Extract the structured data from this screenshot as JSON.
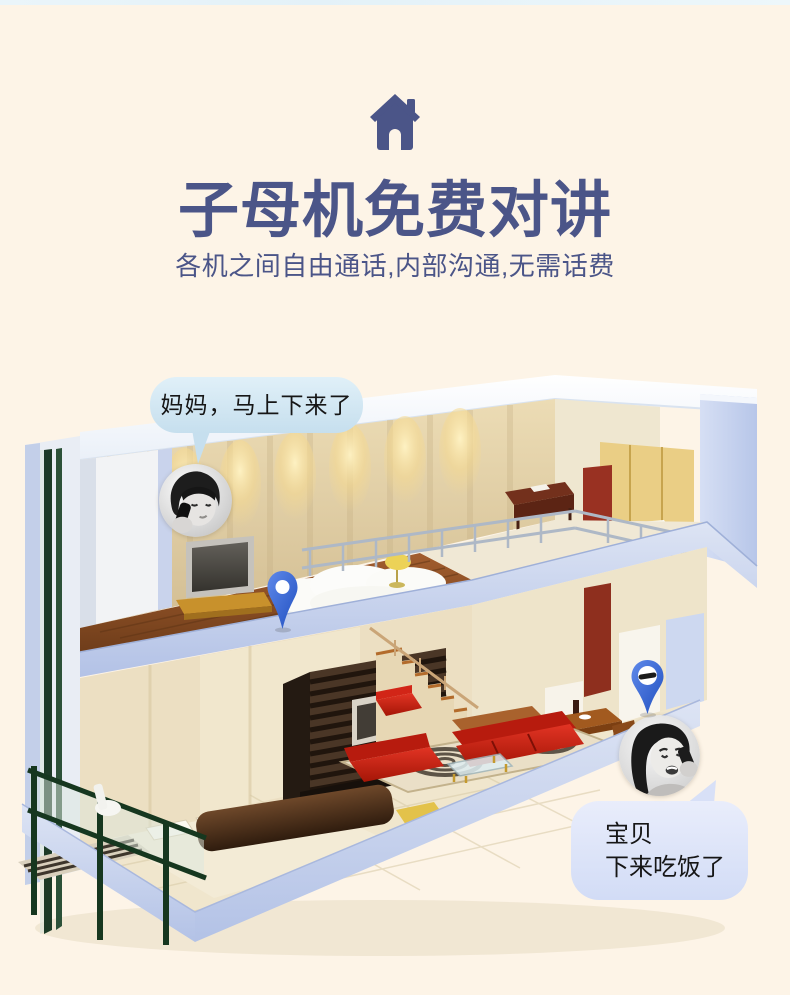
{
  "page": {
    "background": "#fdf4e7",
    "top_strip_color": "#e9f4f9"
  },
  "header": {
    "icon": "house-icon",
    "icon_color": "#4b5588",
    "title": "子母机免费对讲",
    "subtitle": "各机之间自由通话,内部沟通,无需话费",
    "text_color": "#4b5588"
  },
  "scene": {
    "bubble_upstairs": {
      "text": "妈妈，马上下来了",
      "fill": "#cfe4f2"
    },
    "bubble_downstairs": {
      "line1": "宝贝",
      "line2": "下来吃饭了",
      "fill": "#dbe2f7"
    },
    "pins": [
      {
        "name": "location-pin-upstairs"
      },
      {
        "name": "location-pin-downstairs-phone",
        "glyph": "phone-handset"
      }
    ],
    "pin_color": "#2e62d6"
  }
}
